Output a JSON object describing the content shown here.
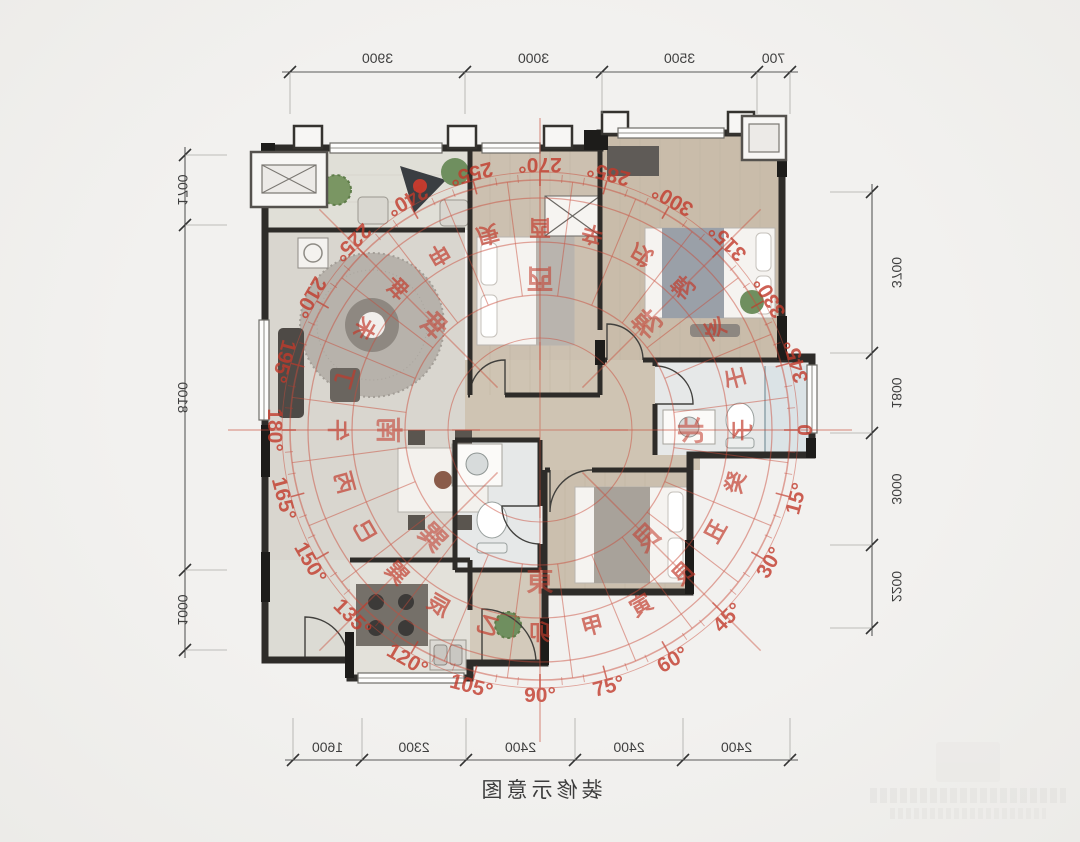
{
  "page": {
    "caption": "装修示意图",
    "background": "#efeeec",
    "paper": "#f1f0ee"
  },
  "colors": {
    "compass_red": "#c23a2b",
    "compass_line": "#c94b3a",
    "wall": "#2e2c29",
    "dim_text": "#3f3f3f",
    "dim_line": "#5a5a5a",
    "wood_floor": "#cbbfae",
    "tile_floor": "#e6e8e8",
    "plant_green": "#6f8f5f"
  },
  "dimensions": {
    "top": [
      "3900",
      "3000",
      "3500",
      "700"
    ],
    "bottom": [
      "1600",
      "2300",
      "2400",
      "2400",
      "2400"
    ],
    "left": [
      "1700",
      "8100",
      "1000"
    ],
    "right": [
      "3700",
      "1800",
      "3000",
      "2200"
    ]
  },
  "compass": {
    "degree_labels": [
      "0",
      "15°",
      "30°",
      "45°",
      "60°",
      "75°",
      "90°",
      "105°",
      "120°",
      "135°",
      "150°",
      "165°",
      "180°",
      "195°",
      "210°",
      "225°",
      "240°",
      "255°",
      "270°",
      "285°",
      "300°",
      "315°",
      "330°",
      "345°"
    ],
    "mountains": [
      "子",
      "癸",
      "丑",
      "艮",
      "寅",
      "甲",
      "卯",
      "乙",
      "辰",
      "巽",
      "巳",
      "丙",
      "午",
      "丁",
      "未",
      "坤",
      "申",
      "庚",
      "酉",
      "辛",
      "戌",
      "乾",
      "亥",
      "壬"
    ],
    "directions": [
      "北",
      "艮",
      "東",
      "巽",
      "南",
      "坤",
      "西",
      "乾"
    ]
  }
}
